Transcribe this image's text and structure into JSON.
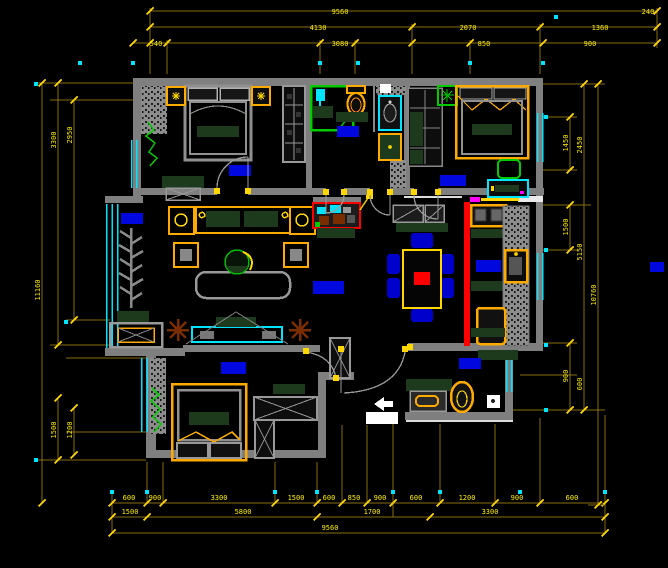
{
  "canvas": {
    "width": 668,
    "height": 568,
    "background": "#000000",
    "type": "cad-floor-plan"
  },
  "colors": {
    "walls": "#7f7f7f",
    "dimension_lines": "#8a6d0a",
    "dimension_text": "#ffee00",
    "windows": "#00e5ff",
    "room_labels": "#0008e0",
    "wood_accent": "#ffaa00",
    "counter_green": "#1d3a1d",
    "slider_red": "#ff0000",
    "plant_green": "#00cc00",
    "chair_blue": "#0000cc",
    "plant_brown": "#7a2e00"
  },
  "dims": {
    "top": [
      [
        "9560",
        "240"
      ],
      [
        "4130",
        "2070",
        "1360"
      ],
      [
        "540",
        "3080",
        "850",
        "900"
      ]
    ],
    "bottom": [
      [
        "600",
        "900",
        "3300",
        "1500",
        "600",
        "850",
        "900",
        "600",
        "1200",
        "900",
        "600"
      ],
      [
        "1500",
        "5800",
        "1700",
        "3300"
      ],
      [
        "9560"
      ]
    ],
    "left": [
      [
        "11160"
      ],
      [
        "3300",
        "1500"
      ],
      [
        "2950",
        "1200"
      ]
    ],
    "right": [
      [
        "1450",
        "1500",
        "900"
      ],
      [
        "2450",
        "5150",
        "600"
      ],
      [
        "10760"
      ]
    ]
  }
}
